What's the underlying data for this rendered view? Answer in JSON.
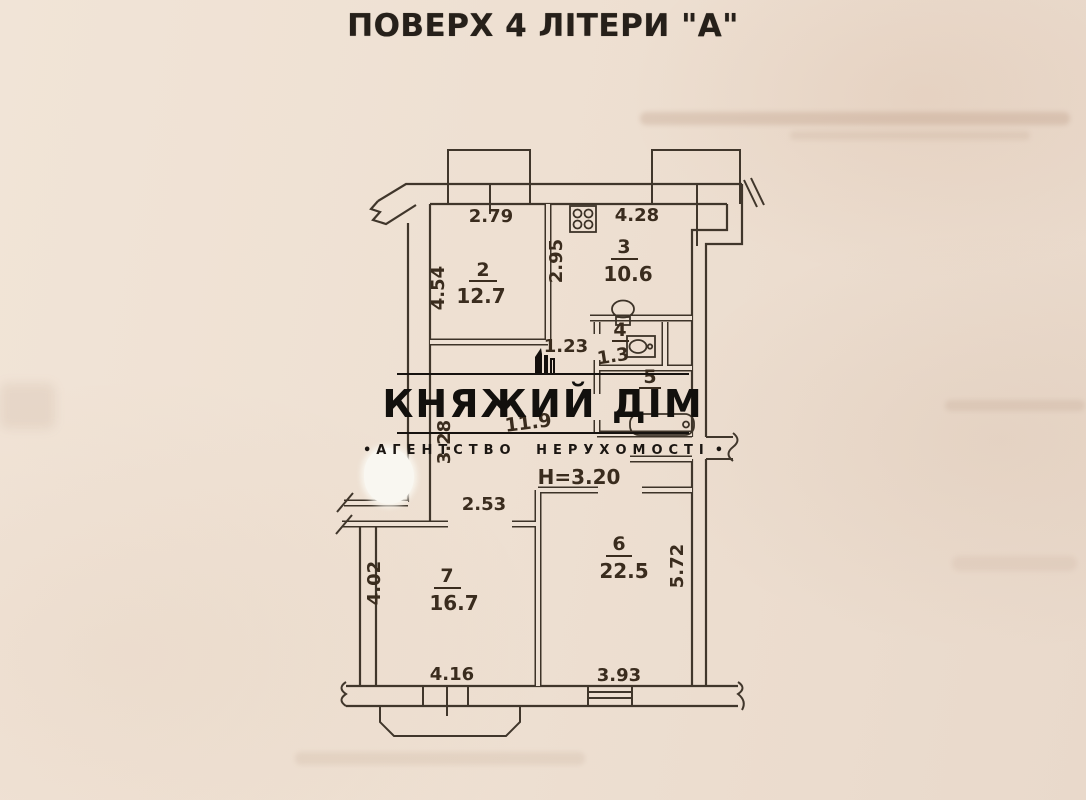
{
  "title": "ПОВЕРХ 4 ЛІТЕРИ \"А\"",
  "watermark": {
    "name": "КНЯЖИЙ ДІМ",
    "tagline": "АГЕНТСТВО НЕРУХОМОСТІ",
    "bullet_left": "•",
    "bullet_right": "•"
  },
  "plan": {
    "ceiling_height": "Н=3.20",
    "rooms": {
      "room2": {
        "number": "2",
        "area": "12.7"
      },
      "room3": {
        "number": "3",
        "area": "10.6"
      },
      "room4": {
        "number": "4",
        "area": "1.3"
      },
      "room5": {
        "number": "5"
      },
      "room6": {
        "number": "6",
        "area": "22.5"
      },
      "room7": {
        "number": "7",
        "area": "16.7"
      },
      "corridor": {
        "area": "11.9"
      }
    },
    "dimensions": {
      "room2_width": "2.79",
      "room2_depth": "4.54",
      "kitchen_width": "4.28",
      "kitchen_depth": "2.95",
      "wc_passage_width": "1.23",
      "corridor_depth": "3.28",
      "hall_width": "2.53",
      "room7_depth": "4.02",
      "room7_width": "4.16",
      "room6_width": "3.93",
      "room6_depth": "5.72"
    },
    "fixture_icons": [
      "stove-icon",
      "toilet-icon",
      "sink-icon",
      "bathtub-icon"
    ],
    "ink_color": "#3f352a",
    "paper_color": "#eee1d4"
  }
}
